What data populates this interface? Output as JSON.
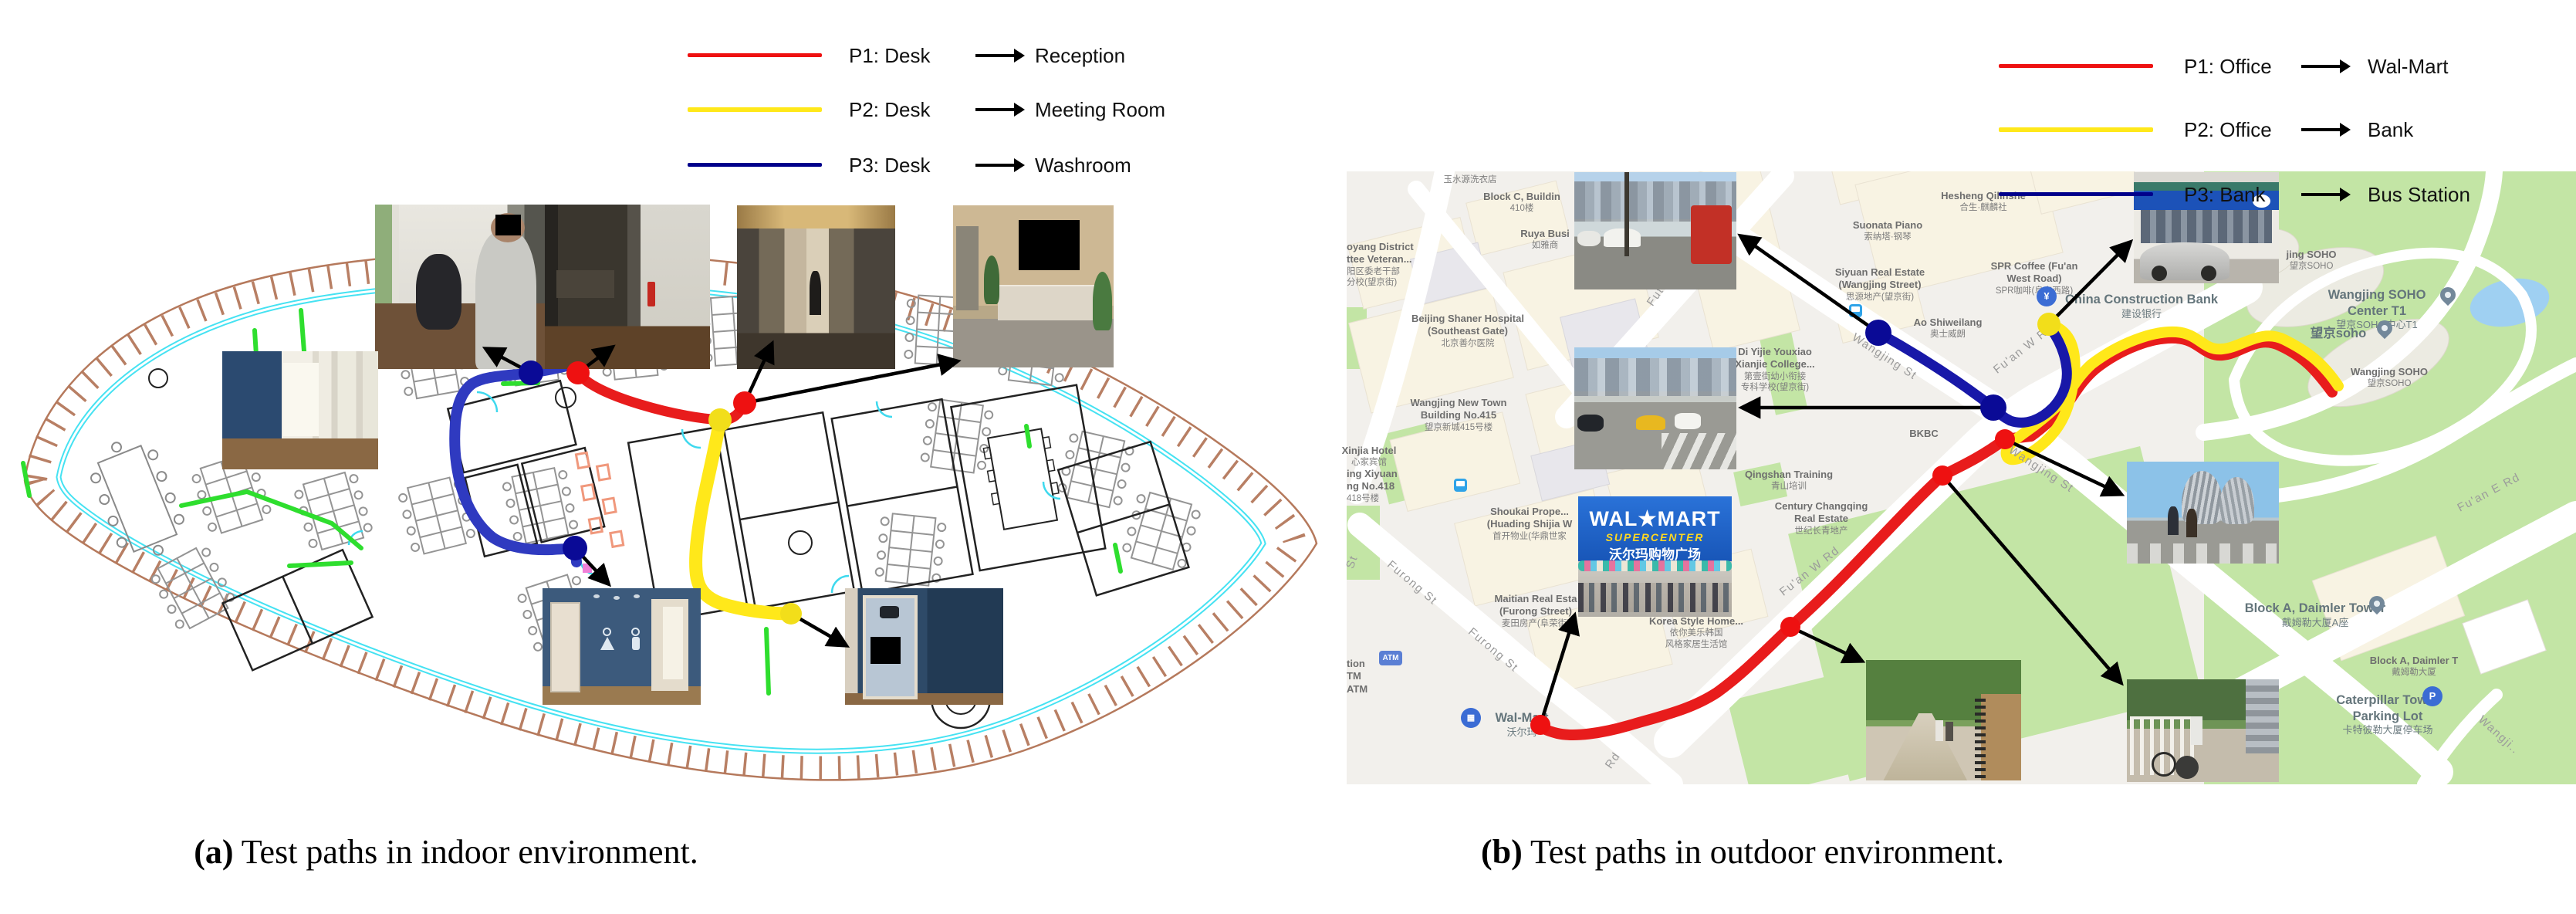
{
  "captions": {
    "a_label": "(a)",
    "a_text": "Test paths in indoor environment.",
    "b_label": "(b)",
    "b_text": "Test paths in outdoor environment."
  },
  "indoor": {
    "legend": [
      {
        "source": "P1: Desk",
        "target": "Reception",
        "color": "#ee1111"
      },
      {
        "source": "P2: Desk",
        "target": "Meeting Room",
        "color": "#ffe81a"
      },
      {
        "source": "P3: Desk",
        "target": "Washroom",
        "color": "#00008b"
      }
    ]
  },
  "outdoor": {
    "legend": [
      {
        "source": "P1: Office",
        "target": "Wal-Mart",
        "color": "#ee1111"
      },
      {
        "source": "P2: Office",
        "target": "Bank",
        "color": "#ffe81a"
      },
      {
        "source": "P3: Bank",
        "target": "Bus Station",
        "color": "#00008b"
      }
    ],
    "labels": [
      {
        "l1": "玉水源洗衣店"
      },
      {
        "l1": "Block C, Buildin",
        "l2": "410楼"
      },
      {
        "l1": "Ruya Busi",
        "l2": "如雅商"
      },
      {
        "l1": "oyang District",
        "l2": "ttee Veteran...",
        "l3": "阳区委老干部",
        "l4": "分校(望京街)"
      },
      {
        "l1": "Beijing Shaner Hospital",
        "l2": "(Southeast Gate)",
        "l3": "北京善尔医院"
      },
      {
        "l1": "Wangjing New Town",
        "l2": "Building No.415",
        "l3": "望京新城415号楼"
      },
      {
        "l1": "Xinjia Hotel",
        "l2": "心家宾馆"
      },
      {
        "l1": "ing Xiyuan",
        "l2": "ng No.418",
        "l3": "418号楼"
      },
      {
        "l1": "Hesheng Qilinshe",
        "l2": "合生·麒麟社"
      },
      {
        "l1": "Suonata Piano",
        "l2": "索纳塔·钢琴"
      },
      {
        "l1": "Siyuan Real Estate",
        "l2": "(Wangjing Street)",
        "l3": "思源地产(望京街)"
      },
      {
        "l1": "SPR Coffee (Fu'an",
        "l2": "West Road)",
        "l3": "SPR咖啡(阜安西路)"
      },
      {
        "l1": "China Construction Bank",
        "l2": "建设银行"
      },
      {
        "l1": "Ao Shiweilang",
        "l2": "奥士威朗"
      },
      {
        "l1": "Di Yijie Youxiao",
        "l2": "Xianjie College...",
        "l3": "第壹街幼小衔接",
        "l4": "专科学校(望京街)"
      },
      {
        "l1": "BKBC"
      },
      {
        "l1": "Qingshan Training",
        "l2": "青山培训"
      },
      {
        "l1": "Century Changqing",
        "l2": "Real Estate",
        "l3": "世纪长青地产"
      },
      {
        "l1": "Shoukai Prope...",
        "l2": "(Huading Shijia W",
        "l3": "首开物业(华鼎世家"
      },
      {
        "l1": "Maitian Real Esta",
        "l2": "(Furong Street)",
        "l3": "麦田房产(阜荣街)"
      },
      {
        "l1": "Korea Style Home...",
        "l2": "依你美乐韩国",
        "l3": "风格家居生活馆"
      },
      {
        "l1": "Wal-Mart",
        "l2": "沃尔玛"
      },
      {
        "l1": "tion",
        "l2": "TM",
        "l3": "ATM"
      },
      {
        "l1": "jing SOHO",
        "l2": "望京SOHO"
      },
      {
        "l1": "Wangjing SOHO",
        "l2": "Center T1",
        "l3": "望京SOHO中心T1"
      },
      {
        "l1": "望京soho"
      },
      {
        "l1": "Wangjing SOHO",
        "l2": "望京SOHO"
      },
      {
        "l1": "Block A, Daimler Tower",
        "l2": "戴姆勒大厦A座"
      },
      {
        "l1": "Block A, Daimler T",
        "l2": "戴姆勒大厦"
      },
      {
        "l1": "Caterpillar Tower",
        "l2": "Parking Lot",
        "l3": "卡特彼勒大厦停车场"
      }
    ],
    "roads": [
      {
        "t": "Wangjing St"
      },
      {
        "t": "Wangjing St"
      },
      {
        "t": "Fu'an W Rd"
      },
      {
        "t": "Fu'an W Rd"
      },
      {
        "t": "Fu'an E Rd"
      },
      {
        "t": "Furong St"
      },
      {
        "t": "Furong St"
      },
      {
        "t": "Futo"
      },
      {
        "t": "Rd"
      },
      {
        "t": "St"
      },
      {
        "t": "Wangji.."
      }
    ],
    "icons": {
      "atm": "ATM",
      "parking": "P",
      "yuan": "¥"
    },
    "walmart_sign": {
      "brand": "WAL★MART",
      "sub": "SUPERCENTER",
      "zh": "沃尔玛购物广场"
    },
    "map_colors": {
      "green": "#c3e5a5",
      "road": "#ffffff",
      "block": "#f8f3e3",
      "water": "#9fd0f2",
      "bg": "#f2f0ec"
    }
  },
  "path_colors": {
    "p1_red": "#e81c1c",
    "p2_yellow": "#ffe81a",
    "p3_blue": "#2f3ac0",
    "dot_navy": "#0a0a96",
    "dot_red": "#ee1111",
    "dot_yellow": "#f2de1a"
  }
}
